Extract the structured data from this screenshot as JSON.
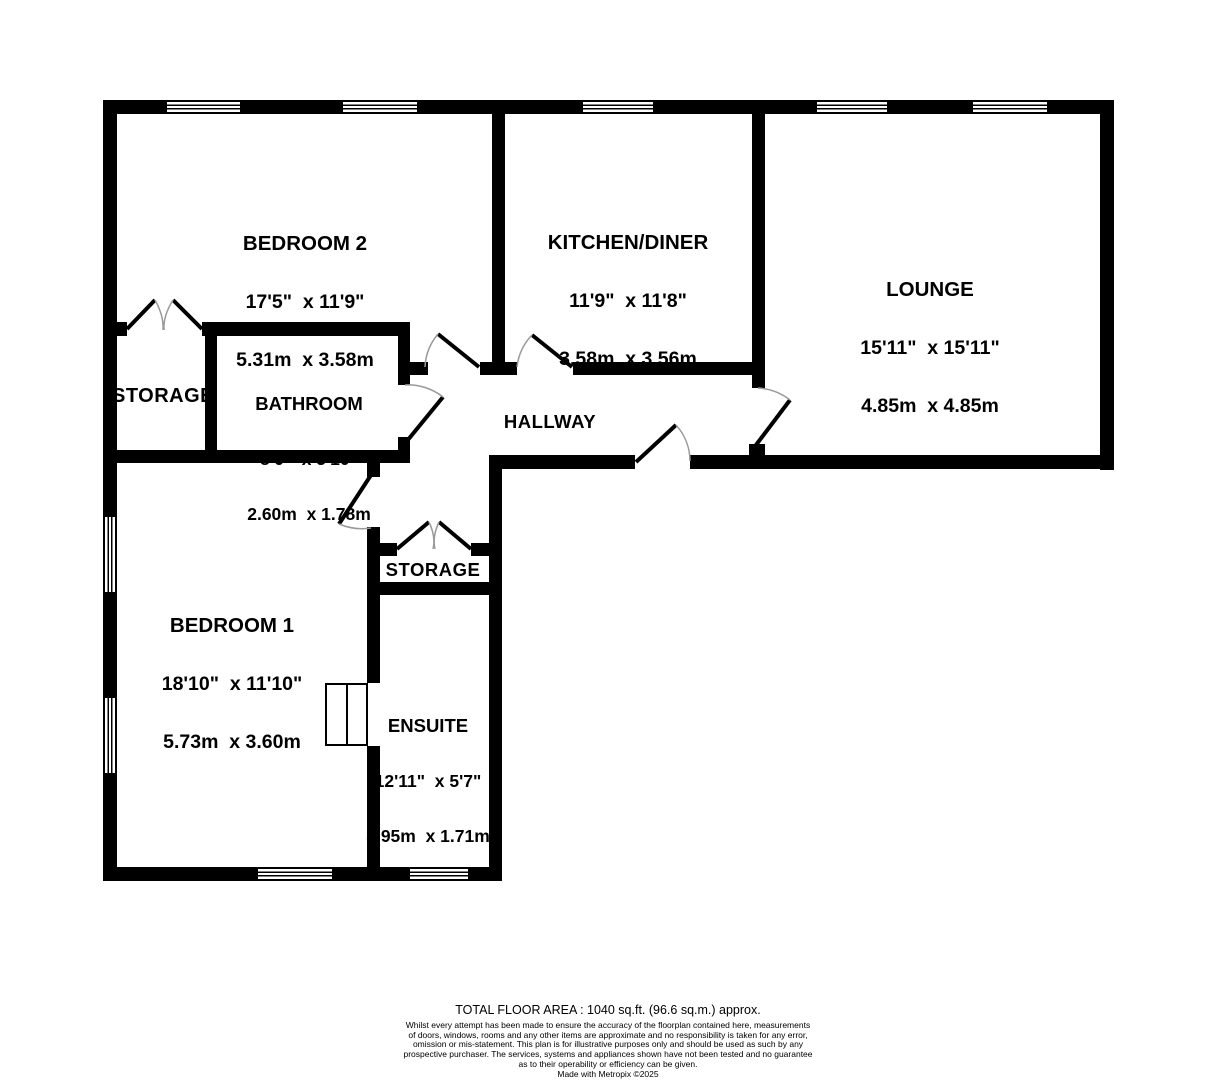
{
  "plan": {
    "colors": {
      "wall": "#000000",
      "background": "#ffffff",
      "door_arc": "#999999"
    },
    "rooms": {
      "bedroom2": {
        "name": "BEDROOM 2",
        "imperial": "17'5\"  x 11'9\"",
        "metric": "5.31m  x 3.58m"
      },
      "kitchen_diner": {
        "name": "KITCHEN/DINER",
        "imperial": "11'9\"  x 11'8\"",
        "metric": "3.58m  x 3.56m"
      },
      "lounge": {
        "name": "LOUNGE",
        "imperial": "15'11\"  x 15'11\"",
        "metric": "4.85m  x 4.85m"
      },
      "bathroom": {
        "name": "BATHROOM",
        "imperial": "8'6\"  x 5'10\"",
        "metric": "2.60m  x 1.78m"
      },
      "storage_left": {
        "name": "STORAGE"
      },
      "hallway": {
        "name": "HALLWAY"
      },
      "bedroom1": {
        "name": "BEDROOM 1",
        "imperial": "18'10\"  x 11'10\"",
        "metric": "5.73m  x 3.60m"
      },
      "storage_middle": {
        "name": "STORAGE"
      },
      "ensuite": {
        "name": "ENSUITE",
        "imperial": "12'11\"  x 5'7\"",
        "metric": "3.95m  x 1.71m"
      }
    }
  },
  "footer": {
    "total_area": "TOTAL FLOOR AREA : 1040 sq.ft. (96.6 sq.m.) approx.",
    "disclaimer_lines": [
      "Whilst every attempt has been made to ensure the accuracy of the floorplan contained here, measurements",
      "of doors, windows, rooms and any other items are approximate and no responsibility is taken for any error,",
      "omission or mis-statement. This plan is for illustrative purposes only and should be used as such by any",
      "prospective purchaser. The services, systems and appliances shown have not been tested and no guarantee",
      "as to their operability or efficiency can be given."
    ],
    "credit": "Made with Metropix ©2025"
  }
}
